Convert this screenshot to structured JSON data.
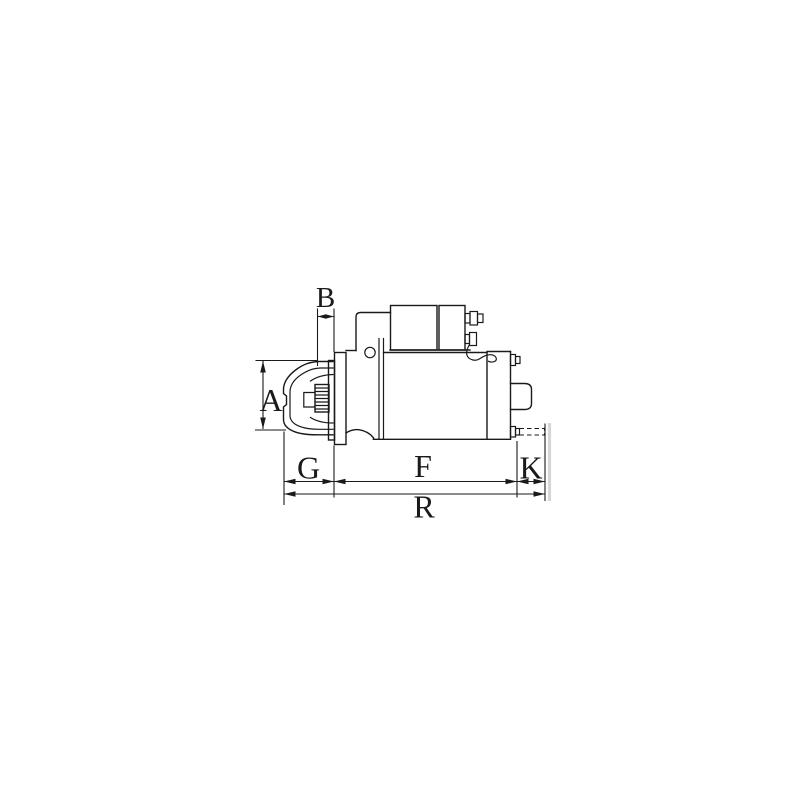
{
  "page": {
    "background_color": "#ffffff"
  },
  "diagram": {
    "description": "Technical line drawing of a starter motor, side view, with dimension callouts",
    "line_color": "#1a1a1a",
    "artifact_color": "#d6d6d6",
    "dimension_labels": {
      "A": "A",
      "B": "B",
      "G": "G",
      "F": "F",
      "K": "K",
      "R": "R"
    }
  }
}
